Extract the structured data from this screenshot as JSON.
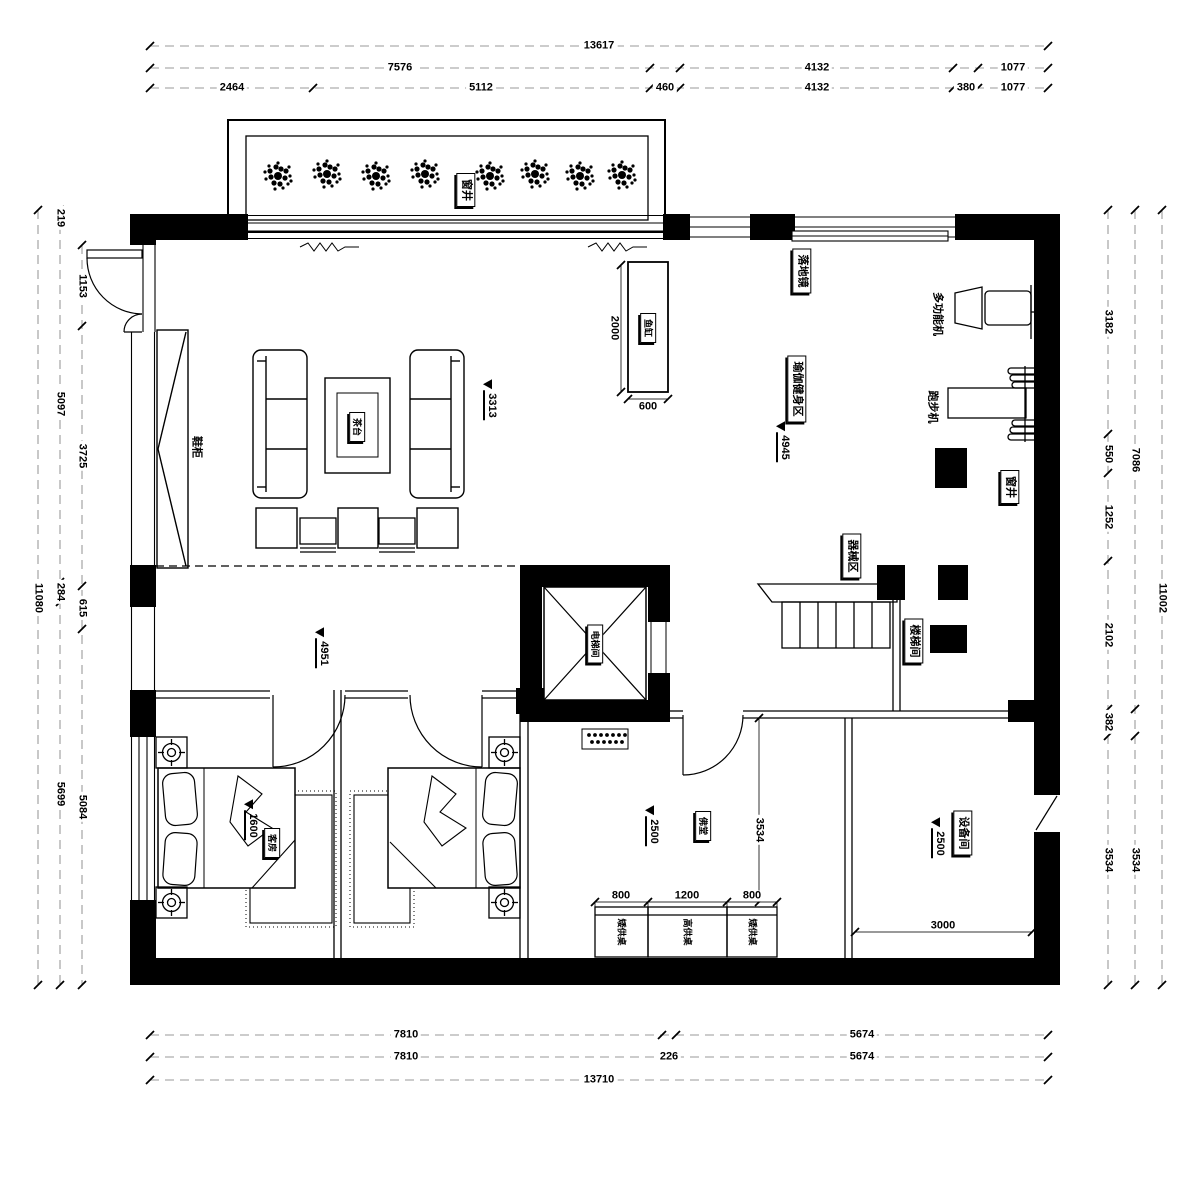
{
  "plan": {
    "rooms": {
      "window_well_top": "窗井",
      "window_well_right": "窗井",
      "yoga_area": "瑜伽健身区",
      "equipment_zone": "器械区",
      "stair_room": "楼梯间",
      "elevator_room": "电梯间",
      "guest_room": "客房",
      "buddha_hall": "佛堂",
      "equipment_room": "设备间"
    },
    "furniture": {
      "shoe_cabinet": "鞋柜",
      "tea_table": "茶台",
      "fish_tank": "鱼缸",
      "floor_mirror": "落地镜",
      "multi_gym": "多功能机",
      "treadmill": "跑步机",
      "low_altar_left": "矮供桌",
      "high_altar": "高供桌",
      "low_altar_right": "矮供桌"
    },
    "level_markers": {
      "living": "3313",
      "yoga": "4945",
      "hall": "4951",
      "guest": "1600",
      "buddha": "2500",
      "equipment": "2500"
    },
    "dims": {
      "top1": [
        "13617"
      ],
      "top2": [
        "7576",
        "4132",
        "1077"
      ],
      "top3": [
        "2464",
        "5112",
        "460",
        "4132",
        "380",
        "1077"
      ],
      "bottom1": [
        "7810",
        "5674"
      ],
      "bottom2": [
        "7810",
        "226",
        "5674"
      ],
      "bottom3": [
        "13710"
      ],
      "left_outer": [
        "11080"
      ],
      "left_mid": [
        "219",
        "5097",
        "284",
        "5699"
      ],
      "left_in": [
        "1153",
        "3725",
        "615",
        "5084"
      ],
      "right_in": [
        "3182",
        "550",
        "1252",
        "2102",
        "382",
        "3534"
      ],
      "right_mid": [
        "7086",
        "3534"
      ],
      "right_outer": [
        "11002"
      ],
      "fish_tank_h": "2000",
      "fish_tank_w": "600",
      "altar": [
        "800",
        "1200",
        "800"
      ],
      "buddha_depth": "3534",
      "equipment_w": "3000"
    }
  }
}
